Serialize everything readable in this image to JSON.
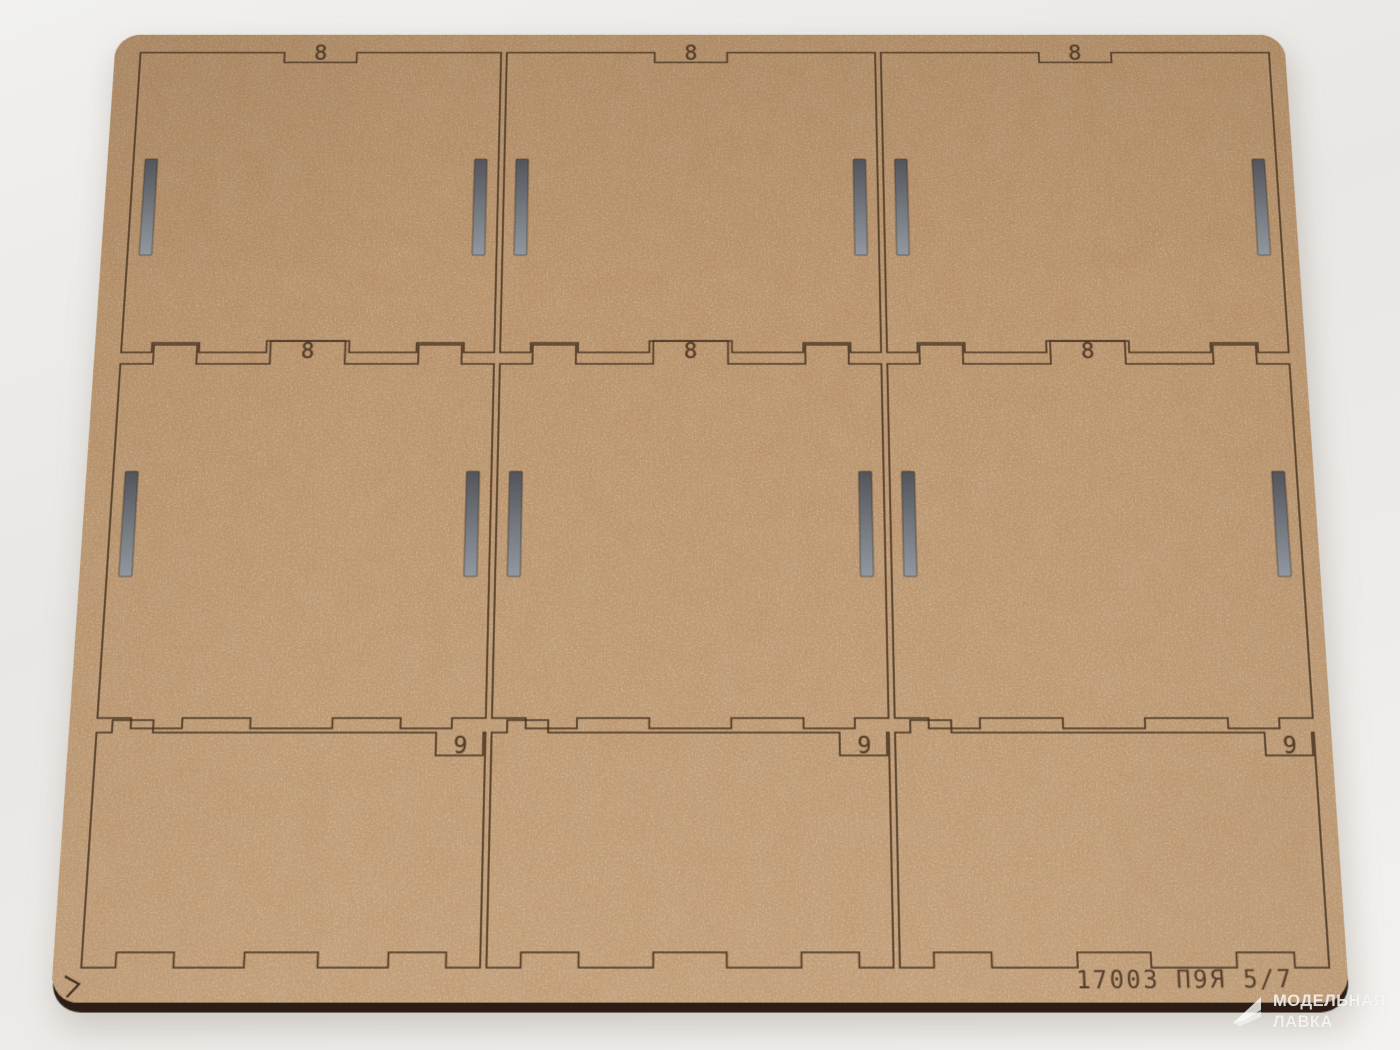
{
  "scene": {
    "description": "Photograph of a laser-cut MDF flat-pack parts sheet lying on a light grey surface",
    "background_top_color": "#f1f0ee",
    "background_bottom_color": "#f4f2ef"
  },
  "board": {
    "material": "MDF hardboard sheet",
    "base_color": "#b78d63",
    "cut_line_color": "#3f2c1c",
    "side_edge_color": "#2c1e14",
    "engraving_color": "#4c3523",
    "slot_top_color": "#54555b",
    "slot_bottom_color": "#9298a0",
    "footer_code": "17003 П9Я 5/7",
    "rows": 3,
    "cols": 3,
    "corner_mark_icon": "alignment-chevron",
    "panels": [
      {
        "id": "panel-top-left",
        "row": 1,
        "col": 1,
        "label": "8"
      },
      {
        "id": "panel-top-center",
        "row": 1,
        "col": 2,
        "label": "8"
      },
      {
        "id": "panel-top-right",
        "row": 1,
        "col": 3,
        "label": "8"
      },
      {
        "id": "panel-middle-left",
        "row": 2,
        "col": 1,
        "label": "8"
      },
      {
        "id": "panel-middle-center",
        "row": 2,
        "col": 2,
        "label": "8"
      },
      {
        "id": "panel-middle-right",
        "row": 2,
        "col": 3,
        "label": "8"
      },
      {
        "id": "panel-bottom-left",
        "row": 3,
        "col": 1,
        "label": "9"
      },
      {
        "id": "panel-bottom-center",
        "row": 3,
        "col": 2,
        "label": "9"
      },
      {
        "id": "panel-bottom-right",
        "row": 3,
        "col": 3,
        "label": "9"
      }
    ]
  },
  "watermark": {
    "logo_icon": "modelnaya-lavka-logo",
    "line1": "МОДЕЛЬНАЯ",
    "line2": "ЛАВКА",
    "color": "#ffffff"
  }
}
